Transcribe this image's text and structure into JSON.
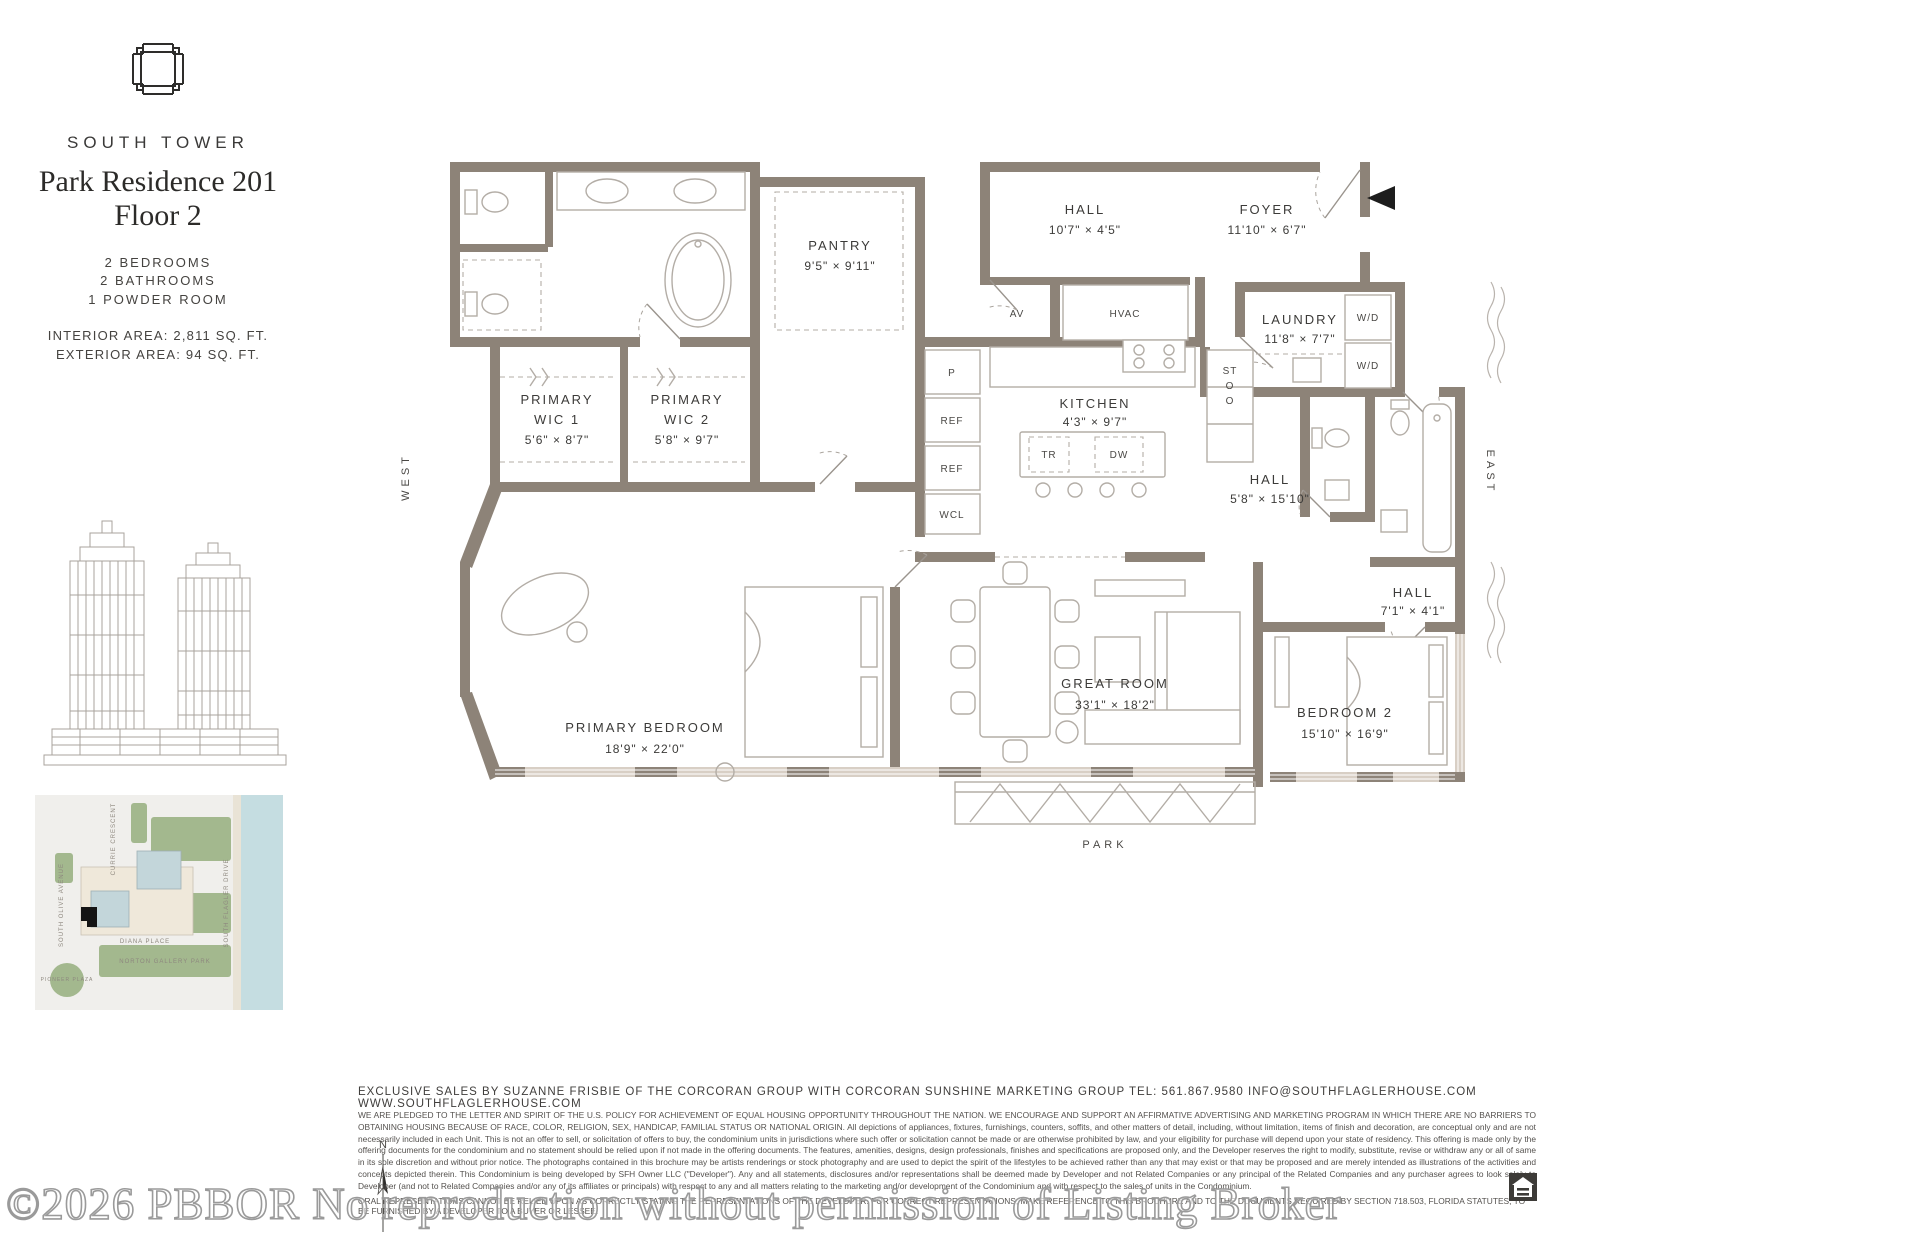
{
  "header": {
    "tower": "SOUTH TOWER",
    "title_line1": "Park Residence 201",
    "title_line2": "Floor 2",
    "bedrooms": "2 BEDROOMS",
    "bathrooms": "2 BATHROOMS",
    "powder_room": "1 POWDER ROOM",
    "interior_area": "INTERIOR AREA: 2,811 SQ. FT.",
    "exterior_area": "EXTERIOR AREA: 94 SQ. FT."
  },
  "plan": {
    "rooms": {
      "pantry": {
        "name": "PANTRY",
        "dims": "9'5\" × 9'11\""
      },
      "hall1": {
        "name": "HALL",
        "dims": "10'7\" × 4'5\""
      },
      "foyer": {
        "name": "FOYER",
        "dims": "11'10\" × 6'7\""
      },
      "laundry": {
        "name": "LAUNDRY",
        "dims": "11'8\" × 7'7\""
      },
      "hall2": {
        "name": "HALL",
        "dims": "5'8\" × 15'10\""
      },
      "kitchen": {
        "name": "KITCHEN",
        "dims": "4'3\" × 9'7\""
      },
      "wic1": {
        "l1": "PRIMARY",
        "l2": "WIC 1",
        "dims": "5'6\" × 8'7\""
      },
      "wic2": {
        "l1": "PRIMARY",
        "l2": "WIC 2",
        "dims": "5'8\" × 9'7\""
      },
      "primary_bedroom": {
        "name": "PRIMARY BEDROOM",
        "dims": "18'9\" × 22'0\""
      },
      "great_room": {
        "name": "GREAT ROOM",
        "dims": "33'1\" × 18'2\""
      },
      "bedroom2": {
        "name": "BEDROOM 2",
        "dims": "15'10\" × 16'9\""
      },
      "hall3": {
        "name": "HALL",
        "dims": "7'1\" × 4'1\""
      }
    },
    "labels": {
      "av": "AV",
      "hvac": "HVAC",
      "wd": "W/D",
      "p": "P",
      "ref": "REF",
      "wcl": "WCL",
      "tr": "TR",
      "dw": "DW",
      "st_l1": "ST",
      "st_l2": "O",
      "st_l3": "O"
    },
    "directions": {
      "west": "WEST",
      "east": "EAST",
      "park": "PARK"
    },
    "compass": "N"
  },
  "sitemap": {
    "labels": {
      "currie": "CURRIE CRESCENT",
      "olive": "SOUTH OLIVE AVENUE",
      "flagler": "SOUTH FLAGLER DRIVE",
      "diana": "DIANA PLACE",
      "norton": "NORTON GALLERY PARK",
      "pioneer": "PIONEER PLAZA"
    }
  },
  "footer": {
    "sales_line": "EXCLUSIVE SALES BY SUZANNE FRISBIE OF THE CORCORAN GROUP WITH CORCORAN SUNSHINE MARKETING GROUP    TEL: 561.867.9580    INFO@SOUTHFLAGLERHOUSE.COM    WWW.SOUTHFLAGLERHOUSE.COM",
    "disclaimer": "WE ARE PLEDGED TO THE LETTER AND SPIRIT OF THE U.S. POLICY FOR ACHIEVEMENT OF EQUAL HOUSING OPPORTUNITY THROUGHOUT THE NATION. WE ENCOURAGE AND SUPPORT AN AFFIRMATIVE ADVERTISING AND MARKETING PROGRAM IN WHICH THERE ARE NO BARRIERS TO OBTAINING HOUSING BECAUSE OF RACE, COLOR, RELIGION, SEX, HANDICAP, FAMILIAL STATUS OR NATIONAL ORIGIN. All depictions of appliances, fixtures, furnishings, counters, soffits, and other matters of detail, including, without limitation, items of finish and decoration, are conceptual only and are not necessarily included in each Unit. This is not an offer to sell, or solicitation of offers to buy, the condominium units in jurisdictions where such offer or solicitation cannot be made or are otherwise prohibited by law, and your eligibility for purchase will depend upon your state of residency. This offering is made only by the offering documents for the condominium and no statement should be relied upon if not made in the offering documents. The features, amenities, designs, design professionals, finishes and specifications are proposed only, and the Developer reserves the right to modify, substitute, revise or withdraw any or all of same in its sole discretion and without prior notice. The photographs contained in this brochure may be artists renderings or stock photography and are used to depict the spirit of the lifestyles to be achieved rather than any that may exist or that may be proposed and are merely intended as illustrations of the activities and concepts depicted therein. This Condominium is being developed by SFH Owner LLC (\"Developer\"). Any and all statements, disclosures and/or representations shall be deemed made by Developer and not Related Companies or any principal of the Related Companies and any purchaser agrees to look solely to Developer (and not to Related Companies and/or any of its affiliates or principals) with respect to any and all matters relating to the marketing and/or development of the Condominium and with respect to the sales of units in the Condominium.",
    "oral_line": "ORAL REPRESENTATIONS CANNOT BE RELIED UPON AS CORRECTLY STATING THE REPRESENTATIONS OF THE DEVELOPER. FOR CORRECT REPRESENTATIONS, MAKE REFERENCE TO THIS BROCHURE AND TO THE DOCUMENTS REQUIRED BY SECTION 718.503, FLORIDA STATUTES, TO BE FURNISHED BY A DEVELOPER TO A BUYER OR LESSEE."
  },
  "watermark": "©2026 PBBOR No reproduction without permission of Listing Broker",
  "colors": {
    "wall": "#8d8378",
    "wall_light": "#d8cfc5",
    "fixture_line": "#b3ada6",
    "text": "#3b3a38",
    "map_water": "#c5dde1",
    "map_green": "#a3b88e",
    "map_building": "#efe8da",
    "map_tower": "#c3d6da",
    "map_unit": "#141414"
  }
}
